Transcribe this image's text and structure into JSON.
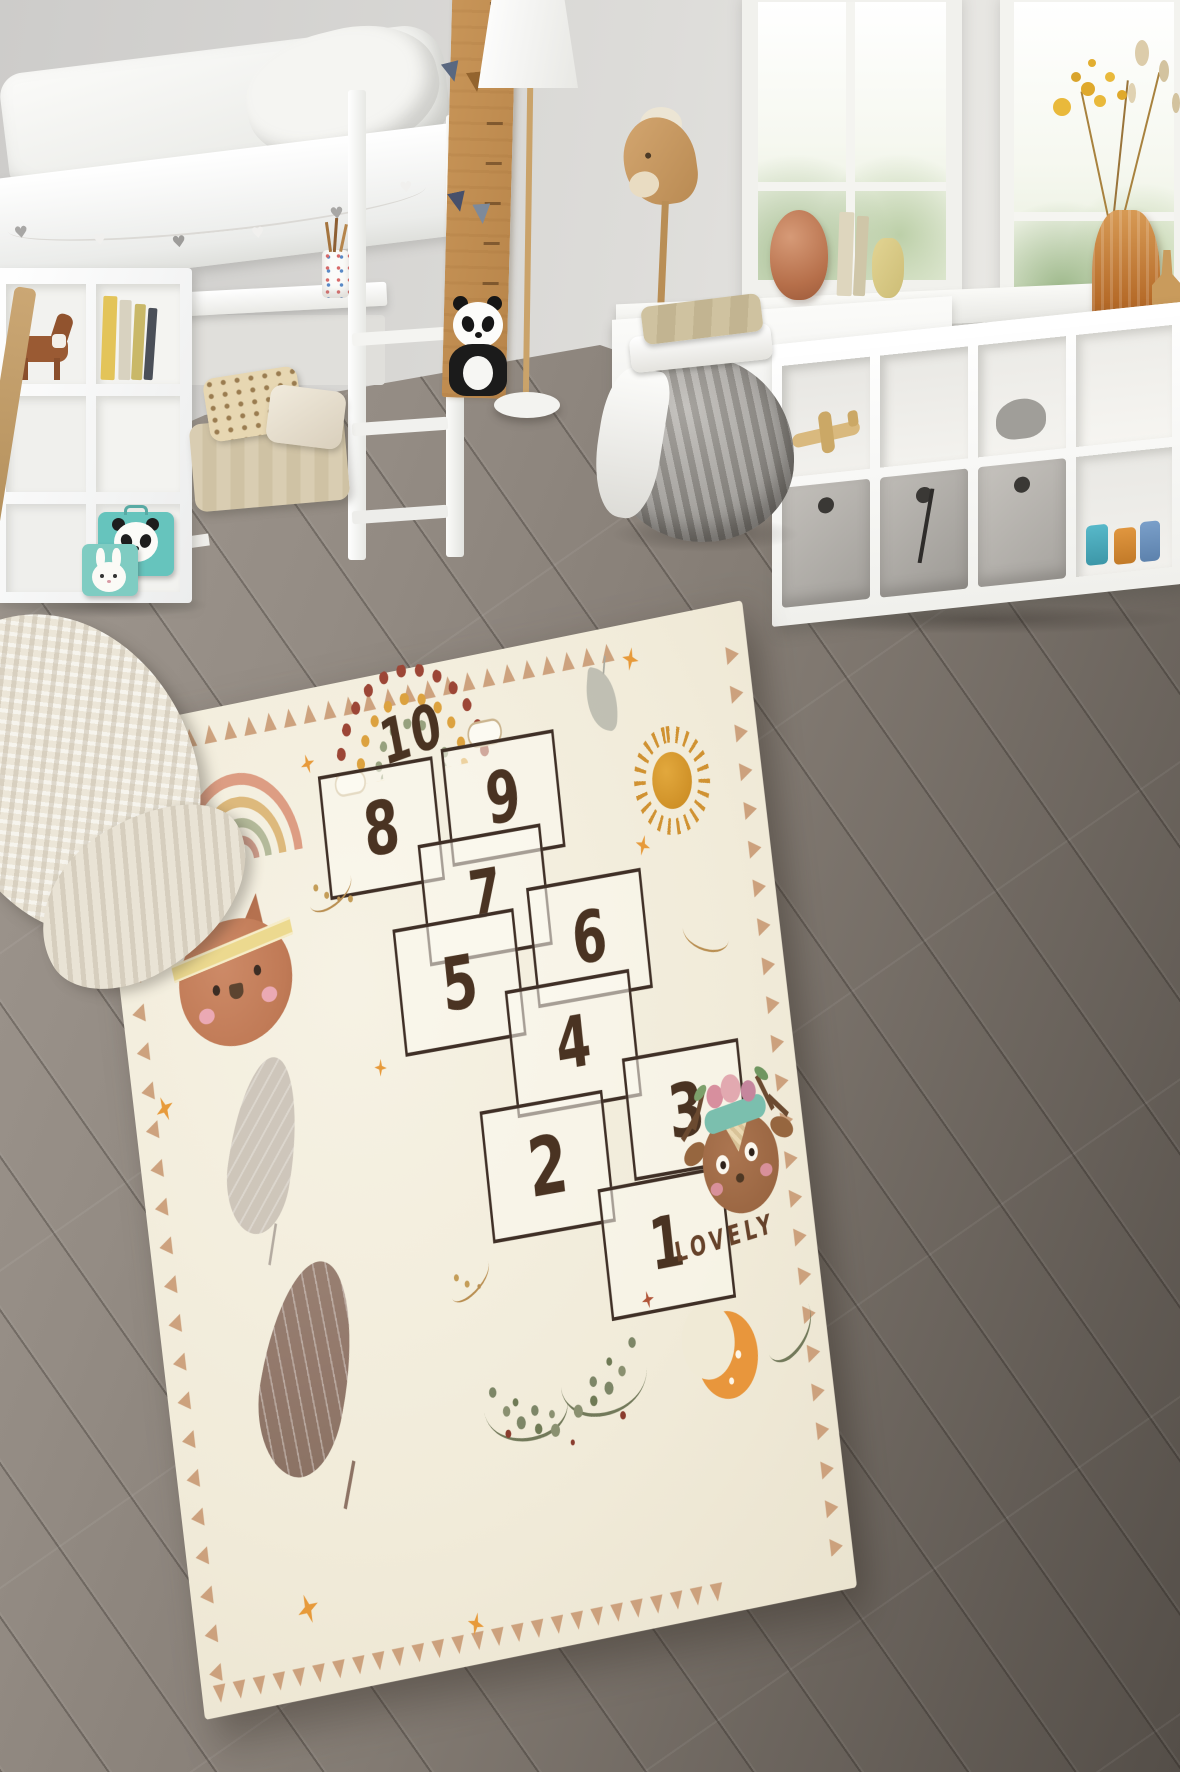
{
  "scene": {
    "type": "product photo",
    "subject": "kids hopscotch play rug in a scandinavian children's bedroom"
  },
  "rug": {
    "word": "LOVELY",
    "numbers": [
      "1",
      "2",
      "3",
      "4",
      "5",
      "6",
      "7",
      "8",
      "9",
      "10"
    ],
    "border": {
      "top": "▲▲▲▲▲▲▲▲▲▲▲▲▲▲▲▲▲▲▲▲▲▲▲▲▲▲",
      "bottom": "▼▼▼▼▼▼▼▼▼▼▼▼▼▼▼▼▼▼▼▼▼▼▼▼▼▼",
      "left": "◀◀◀◀◀◀◀◀◀◀◀◀◀◀◀◀◀◀◀◀◀◀◀◀◀◀",
      "right": "▶▶▶▶▶▶▶▶▶▶▶▶▶▶▶▶▶▶▶▶▶▶▶▶▶▶"
    },
    "colors": {
      "base": "#f3eee0",
      "border_triangle": "#c99a74",
      "number_brown": "#4a3322",
      "accent_orange": "#e79a3a",
      "sage_green": "#7d8766",
      "terracotta": "#c8805d",
      "sun_gold": "#d69a33",
      "moon_orange": "#e8963c"
    },
    "motifs": [
      "dotted-rainbow",
      "watercolor-rainbow",
      "cat-face",
      "deer-face",
      "grey-feather",
      "tribal-feather",
      "hanging-leaf",
      "sun",
      "crescent-moon",
      "laurel-wreath",
      "sparkle-stars",
      "triangle-border"
    ]
  },
  "room": {
    "garland_hearts": "♥"
  }
}
